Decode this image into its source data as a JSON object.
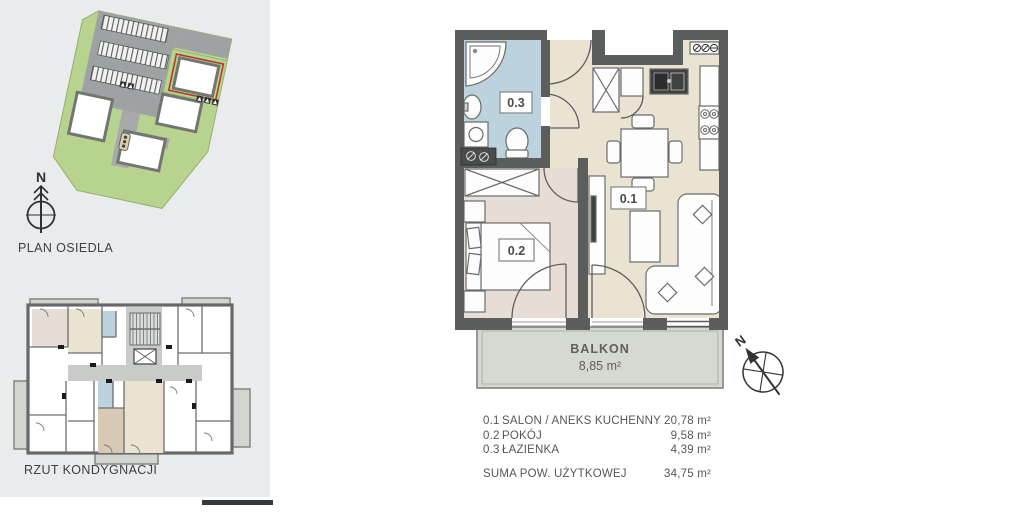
{
  "sidebar": {
    "site_plan": {
      "label": "PLAN OSIEDLA",
      "compass_n": "N"
    },
    "floor_plan": {
      "label": "RZUT KONDYGNACJI"
    }
  },
  "apartment": {
    "rooms": [
      {
        "id": "0.1",
        "name": "SALON / ANEKS KUCHENNY",
        "area": "20,78 m²"
      },
      {
        "id": "0.2",
        "name": "POKÓJ",
        "area": "9,58 m²"
      },
      {
        "id": "0.3",
        "name": "ŁAZIENKA",
        "area": "4,39 m²"
      }
    ],
    "balcony": {
      "label": "BALKON",
      "area": "8,85 m²"
    },
    "total": {
      "label": "SUMA POW. UŻYTKOWEJ",
      "area": "34,75 m²"
    },
    "compass_n": "N"
  },
  "colors": {
    "wall": "#5c5d5d",
    "room_living": "#eae3d2",
    "room_bedroom": "#e7ddd5",
    "room_bath": "#bcd2dc",
    "balcony": "#d6d9d1",
    "sidebar_bg": "#e9ebec",
    "site_green": "#b7d38f",
    "site_gray": "#9fa2a3",
    "highlight_red": "#b23b31"
  }
}
